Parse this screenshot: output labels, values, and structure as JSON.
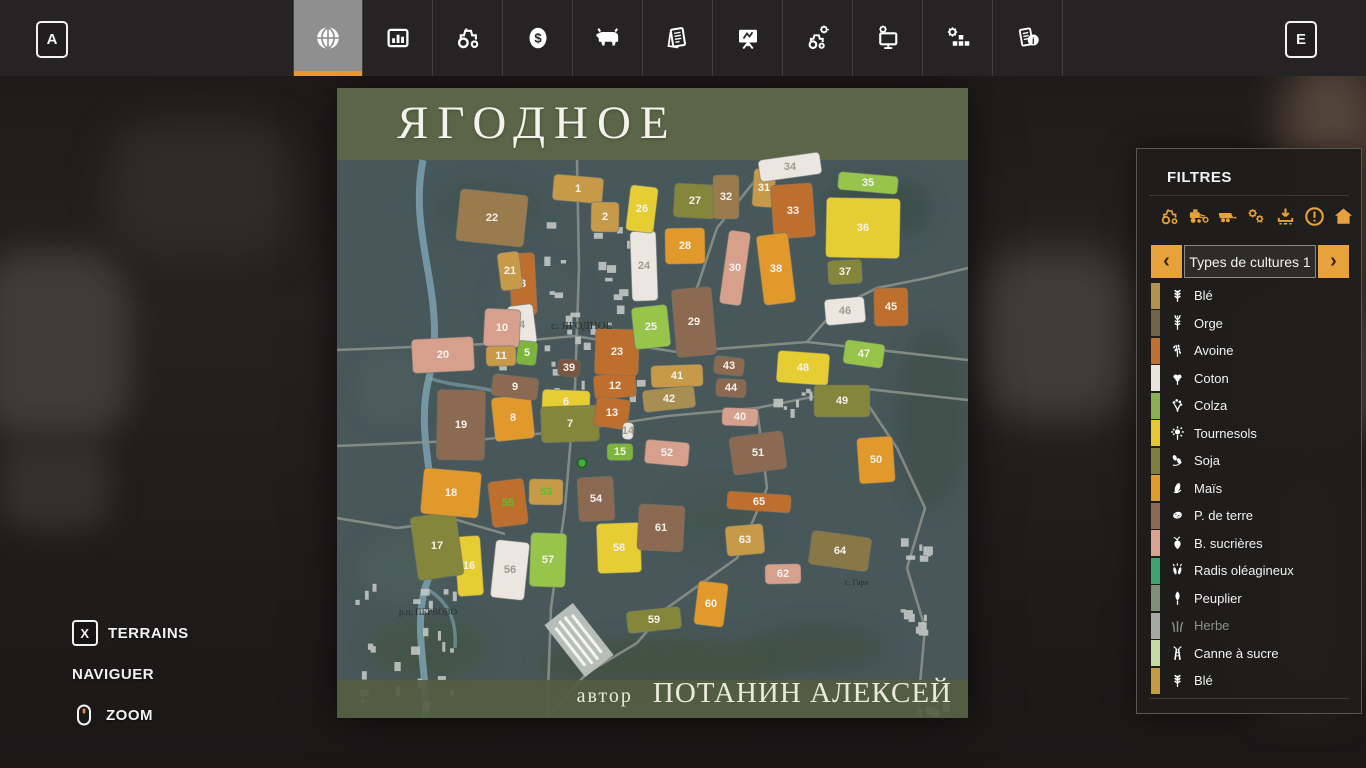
{
  "topbar": {
    "left_key": "A",
    "right_key": "E",
    "tabs": [
      {
        "name": "tab-map",
        "icon": "globe-icon",
        "active": true
      },
      {
        "name": "tab-statistics",
        "icon": "stats-icon",
        "active": false
      },
      {
        "name": "tab-garage",
        "icon": "tractor-icon",
        "active": false
      },
      {
        "name": "tab-finances",
        "icon": "dollar-icon",
        "active": false
      },
      {
        "name": "tab-animals",
        "icon": "cow-icon",
        "active": false
      },
      {
        "name": "tab-contracts",
        "icon": "sheets-icon",
        "active": false
      },
      {
        "name": "tab-production",
        "icon": "presentation-icon",
        "active": false
      },
      {
        "name": "tab-vehicle-settings",
        "icon": "tractor-gear-icon",
        "active": false
      },
      {
        "name": "tab-game-settings",
        "icon": "monitor-gear-icon",
        "active": false
      },
      {
        "name": "tab-general-settings",
        "icon": "gear-blocks-icon",
        "active": false
      },
      {
        "name": "tab-help",
        "icon": "info-icon",
        "active": false
      }
    ]
  },
  "map": {
    "title": "ЯГОДНОЕ",
    "author_label": "автор",
    "author_name": "ПОТАНИН АЛЕКСЕЙ",
    "village_labels": [
      {
        "text": "с. ЯГОДНОЕ",
        "x": 214,
        "y": 241,
        "size": 11
      },
      {
        "text": "р.п. ПЕРВОВО",
        "x": 62,
        "y": 527,
        "size": 9
      },
      {
        "text": "с. Гари",
        "x": 508,
        "y": 497,
        "size": 8
      }
    ],
    "marker": {
      "x": 245,
      "y": 375
    },
    "field_palette": {
      "g": "#c79a49",
      "y": "#e5cd33",
      "o": "#e2992c",
      "a": "#bf6f2d",
      "b": "#8c6a51",
      "db": "#7a5640",
      "p": "#d7a08d",
      "w": "#ebe6e0",
      "gr": "#7db53c",
      "lg": "#97c44a",
      "ol": "#84863c",
      "k": "#a98e52",
      "k2": "#997b4d",
      "ob": "#8a7747"
    },
    "fields_key": [
      "number",
      "x",
      "y",
      "w",
      "h",
      "color"
    ],
    "fields": [
      [
        1,
        241,
        101,
        50,
        26,
        "g"
      ],
      [
        2,
        268,
        129,
        28,
        30,
        "g"
      ],
      [
        3,
        186,
        196,
        26,
        62,
        "a"
      ],
      [
        4,
        185,
        237,
        26,
        40,
        "w"
      ],
      [
        5,
        190,
        265,
        20,
        24,
        "gr"
      ],
      [
        6,
        229,
        314,
        48,
        24,
        "y"
      ],
      [
        7,
        233,
        336,
        58,
        36,
        "ol"
      ],
      [
        8,
        176,
        330,
        40,
        44,
        "o"
      ],
      [
        9,
        178,
        299,
        46,
        22,
        "b"
      ],
      [
        10,
        165,
        240,
        36,
        38,
        "p"
      ],
      [
        11,
        164,
        268,
        30,
        20,
        "g"
      ],
      [
        12,
        278,
        298,
        42,
        24,
        "a"
      ],
      [
        13,
        275,
        325,
        34,
        30,
        "a"
      ],
      [
        14,
        291,
        343,
        11,
        17,
        "w"
      ],
      [
        15,
        283,
        364,
        26,
        17,
        "gr"
      ],
      [
        16,
        132,
        478,
        26,
        60,
        "y"
      ],
      [
        17,
        100,
        458,
        46,
        64,
        "ol"
      ],
      [
        18,
        114,
        405,
        58,
        46,
        "o"
      ],
      [
        19,
        124,
        337,
        48,
        70,
        "b"
      ],
      [
        20,
        106,
        267,
        62,
        34,
        "p"
      ],
      [
        21,
        173,
        183,
        22,
        38,
        "g"
      ],
      [
        22,
        155,
        130,
        68,
        52,
        "k2"
      ],
      [
        23,
        280,
        264,
        44,
        46,
        "a"
      ],
      [
        24,
        307,
        178,
        26,
        70,
        "w"
      ],
      [
        25,
        314,
        239,
        36,
        42,
        "lg"
      ],
      [
        26,
        305,
        121,
        28,
        46,
        "y"
      ],
      [
        27,
        358,
        113,
        42,
        34,
        "ol"
      ],
      [
        28,
        348,
        158,
        40,
        36,
        "o"
      ],
      [
        29,
        357,
        234,
        40,
        68,
        "b"
      ],
      [
        30,
        398,
        180,
        22,
        74,
        "p"
      ],
      [
        31,
        427,
        100,
        22,
        38,
        "g"
      ],
      [
        32,
        389,
        109,
        26,
        44,
        "k2"
      ],
      [
        33,
        456,
        123,
        42,
        54,
        "a"
      ],
      [
        34,
        453,
        79,
        62,
        22,
        "w"
      ],
      [
        35,
        531,
        95,
        60,
        18,
        "lg"
      ],
      [
        36,
        526,
        140,
        74,
        60,
        "y"
      ],
      [
        37,
        508,
        184,
        34,
        24,
        "ol"
      ],
      [
        38,
        439,
        181,
        32,
        70,
        "o"
      ],
      [
        39,
        232,
        280,
        22,
        17,
        "db"
      ],
      [
        40,
        403,
        329,
        36,
        18,
        "p"
      ],
      [
        41,
        340,
        288,
        52,
        22,
        "g"
      ],
      [
        42,
        332,
        311,
        52,
        22,
        "k"
      ],
      [
        43,
        392,
        278,
        30,
        18,
        "b"
      ],
      [
        44,
        394,
        300,
        30,
        18,
        "b"
      ],
      [
        45,
        554,
        219,
        34,
        38,
        "a"
      ],
      [
        46,
        508,
        223,
        40,
        26,
        "w"
      ],
      [
        47,
        527,
        266,
        40,
        24,
        "lg"
      ],
      [
        48,
        466,
        280,
        52,
        32,
        "y"
      ],
      [
        49,
        505,
        313,
        56,
        32,
        "ol"
      ],
      [
        50,
        539,
        372,
        36,
        46,
        "o"
      ],
      [
        51,
        421,
        365,
        54,
        38,
        "b"
      ],
      [
        52,
        330,
        365,
        44,
        24,
        "p"
      ],
      [
        53,
        209,
        404,
        34,
        26,
        "g"
      ],
      [
        54,
        259,
        411,
        36,
        44,
        "b"
      ],
      [
        55,
        171,
        415,
        36,
        46,
        "a"
      ],
      [
        56,
        173,
        482,
        34,
        58,
        "w"
      ],
      [
        57,
        211,
        472,
        36,
        54,
        "lg"
      ],
      [
        58,
        282,
        460,
        44,
        50,
        "y"
      ],
      [
        59,
        317,
        532,
        54,
        22,
        "ol"
      ],
      [
        60,
        374,
        516,
        30,
        44,
        "o"
      ],
      [
        61,
        324,
        440,
        46,
        46,
        "b"
      ],
      [
        62,
        446,
        486,
        36,
        20,
        "p"
      ],
      [
        63,
        408,
        452,
        38,
        30,
        "g"
      ],
      [
        64,
        503,
        463,
        60,
        34,
        "ob"
      ],
      [
        65,
        422,
        414,
        64,
        18,
        "a"
      ]
    ],
    "green_number_fields": [
      53,
      55
    ],
    "colors": {
      "number": "#f4f2ee",
      "number_on_white": "#a09a92",
      "number_green": "#54c02e"
    }
  },
  "filters": {
    "title": "FILTRES",
    "icon_buttons": [
      {
        "name": "filter-tractors-button",
        "icon": "tractor-icon"
      },
      {
        "name": "filter-harvesters-button",
        "icon": "harvester-icon"
      },
      {
        "name": "filter-trailers-button",
        "icon": "trailer-icon"
      },
      {
        "name": "filter-tools-button",
        "icon": "gears-icon"
      },
      {
        "name": "filter-unloading-button",
        "icon": "download-icon"
      },
      {
        "name": "filter-warnings-button",
        "icon": "warning-icon"
      },
      {
        "name": "filter-buildings-button",
        "icon": "house-icon"
      }
    ],
    "selector": {
      "prev": "‹",
      "label": "Types de cultures 1",
      "next": "›"
    },
    "crops": [
      {
        "label": "Blé",
        "color": "#b3924c",
        "icon": "wheat-icon",
        "muted": false
      },
      {
        "label": "Orge",
        "color": "#6e6248",
        "icon": "barley-icon",
        "muted": false
      },
      {
        "label": "Avoine",
        "color": "#bf7030",
        "icon": "oat-icon",
        "muted": false
      },
      {
        "label": "Coton",
        "color": "#eae4de",
        "icon": "cotton-icon",
        "muted": false
      },
      {
        "label": "Colza",
        "color": "#8bb052",
        "icon": "canola-icon",
        "muted": false
      },
      {
        "label": "Tournesols",
        "color": "#e6c832",
        "icon": "sunflower-icon",
        "muted": false
      },
      {
        "label": "Soja",
        "color": "#7e7e41",
        "icon": "soybean-icon",
        "muted": false
      },
      {
        "label": "Maïs",
        "color": "#df9b2e",
        "icon": "corn-icon",
        "muted": false
      },
      {
        "label": "P. de terre",
        "color": "#8a6a55",
        "icon": "potato-icon",
        "muted": false
      },
      {
        "label": "B. sucrières",
        "color": "#d8a391",
        "icon": "beet-icon",
        "muted": false
      },
      {
        "label": "Radis oléagineux",
        "color": "#3fa371",
        "icon": "radish-icon",
        "muted": false
      },
      {
        "label": "Peuplier",
        "color": "#7e9077",
        "icon": "poplar-icon",
        "muted": false
      },
      {
        "label": "Herbe",
        "color": "#a6a8a2",
        "icon": "grass-icon",
        "muted": true
      },
      {
        "label": "Canne à sucre",
        "color": "#c3dba4",
        "icon": "sugarcane-icon",
        "muted": false
      },
      {
        "label": "Blé",
        "color": "#c59a43",
        "icon": "wheat-icon",
        "muted": false
      }
    ],
    "accent_color": "#e8a23b"
  },
  "controls": {
    "terrains_key": "X",
    "terrains_label": "TERRAINS",
    "navigate_label": "NAVIGUER",
    "zoom_label": "ZOOM",
    "mouse_wheel_color": "#e8932c"
  }
}
